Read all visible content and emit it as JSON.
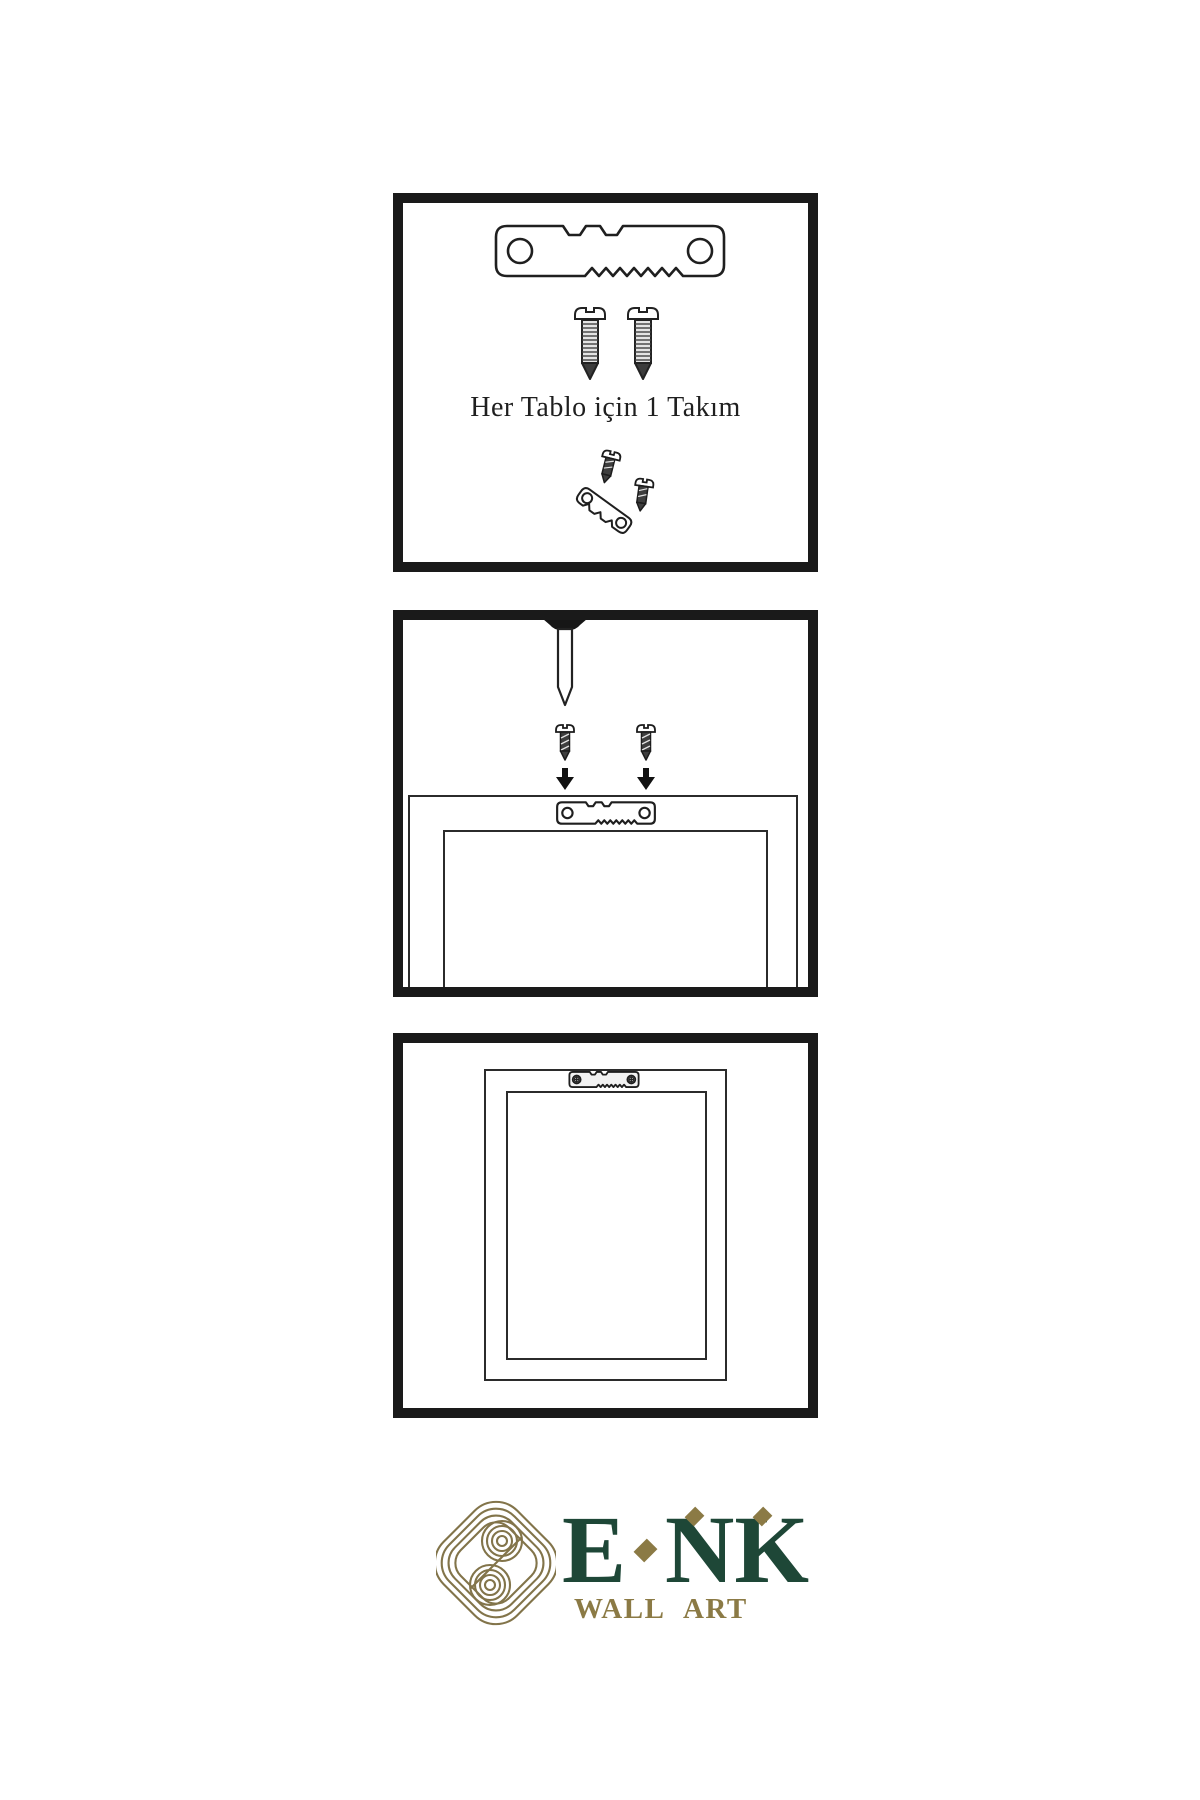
{
  "canvas": {
    "width": 1200,
    "height": 1800,
    "background": "#ffffff"
  },
  "colors": {
    "panel_border": "#1a1a1a",
    "drawing_outline": "#222222",
    "screw_body_dark": "#3e3e3e",
    "logo_green": "#1e4737",
    "logo_gold": "#8b7a45",
    "knot_gold": "#82744a"
  },
  "panel1": {
    "caption": "Her Tablo için 1 Takım",
    "icons": [
      "sawtooth-hanger-icon",
      "screw-icon",
      "screw-icon",
      "screw-and-hanger-kit-icon"
    ]
  },
  "panel2": {
    "icons": [
      "wall-nail-icon",
      "screw-icon",
      "screw-icon",
      "down-arrow-icon",
      "down-arrow-icon",
      "frame-back-with-hanger-icon"
    ]
  },
  "panel3": {
    "icons": [
      "hanging-frame-with-installed-hanger-icon"
    ]
  },
  "logo": {
    "part1": "E",
    "part2": "NK",
    "subtitle": "WALL ART"
  }
}
